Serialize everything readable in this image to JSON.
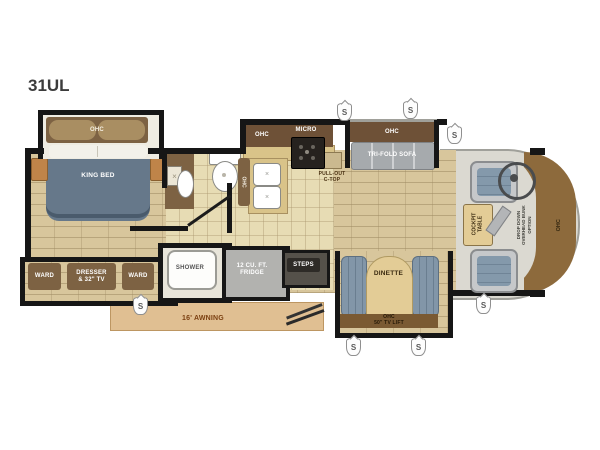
{
  "title": "31UL",
  "icons": {
    "speaker": "S"
  },
  "colors": {
    "wall": "#161616",
    "floor_tan": "#d8c69c",
    "tile": "#e7dcb4",
    "cabinet_brown": "#7d6243",
    "cabinet_dark": "#6e5137",
    "bed_gray": "#66788a",
    "bench_blue": "#8296a8",
    "awning_tan": "#e0bf92",
    "front_cap_brown": "#8d6a3c"
  },
  "bedroom": {
    "ohc": "OHC",
    "bed": "KING BED",
    "ward_left": "WARD",
    "dresser_tv": "DRESSER\n& 32\" TV",
    "ward_right": "WARD"
  },
  "bath": {
    "shower": "SHOWER"
  },
  "kitchen": {
    "ohc": "OHC",
    "micro": "MICRO",
    "pantry_ohc": "OHC",
    "pullout_ctop": "PULL-OUT\nC-TOP",
    "fridge": "12 CU. FT.\nFRIDGE"
  },
  "living": {
    "sofa_ohc": "OHC",
    "sofa": "TRI-FOLD SOFA",
    "steps": "STEPS",
    "dinette": "DINETTE",
    "dinette_cab": "OHC\n50\" TV LIFT"
  },
  "cockpit": {
    "table": "COCKPIT\nTABLE",
    "bunk_option": "DROP DOWN\nOVERHEAD BUNK\nOPTION",
    "front_ohc": "OHC"
  },
  "exterior": {
    "entertainment": "OUTSIDE ENTERTAINMENT\nCENTER",
    "awning": "16' AWNING"
  }
}
